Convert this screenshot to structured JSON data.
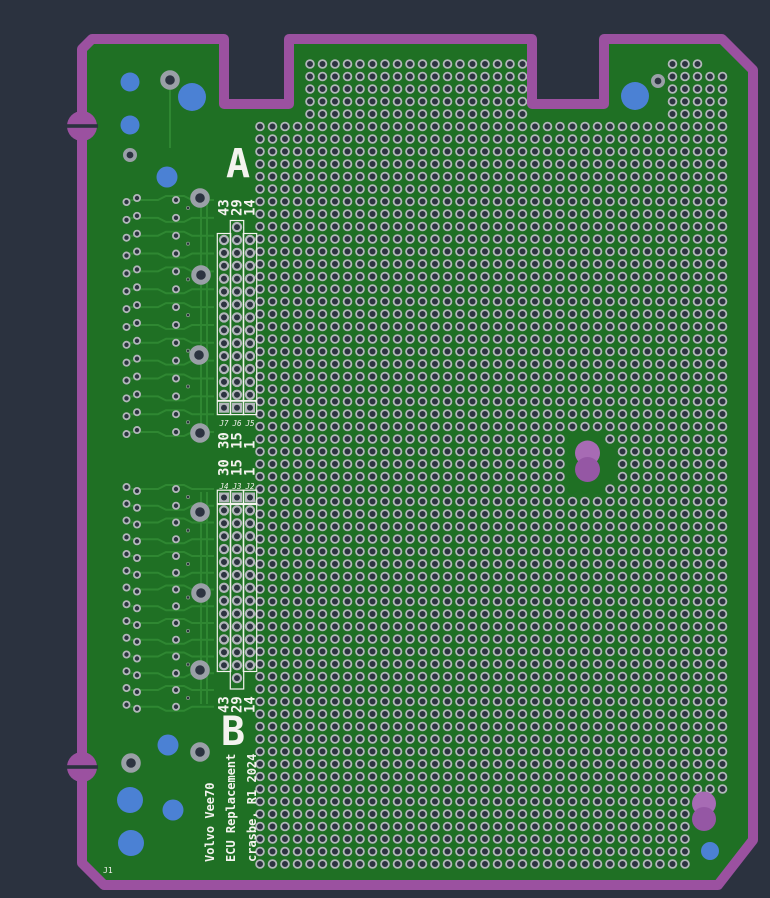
{
  "app": {
    "background": "#2b323f"
  },
  "labels": {
    "connector_a_letter": "A",
    "connector_b_letter": "B",
    "board_ref": "J1",
    "title_lines": [
      "Volvo Vee70",
      "ECU Replacement",
      "crasbe, R1 2024"
    ],
    "conn_a": {
      "top_numbers": [
        "43",
        "29",
        "14"
      ],
      "bottom_numbers": [
        "30",
        "15",
        "1"
      ],
      "refs": [
        "J7",
        "J6",
        "J5"
      ]
    },
    "conn_b": {
      "top_numbers": [
        "30",
        "15",
        "1"
      ],
      "bottom_numbers": [
        "43",
        "29",
        "14"
      ],
      "refs": [
        "J4",
        "J3",
        "J2"
      ]
    }
  },
  "colors": {
    "background": "#2b323f",
    "board_green": "#1f7024",
    "trace_green": "#2f8732",
    "edge_purple": "#9b51a0",
    "slot_purple": "#9557a4",
    "slot_purple_light": "#a76bb4",
    "pad_ring": "#b3b7bb",
    "pad_hole": "#2c3340",
    "via_ring": "#9aa0a7",
    "blue_hole": "#4b81d4",
    "silk_white": "#f4f3ef"
  },
  "perf_grid": {
    "pitch": 12.5,
    "pad_r": 3.9,
    "pad_ring_w": 1.8,
    "main": {
      "x0": 260,
      "y0": 126.5,
      "cols": 38,
      "rows": 60
    },
    "top_tab": {
      "x0": 310,
      "y0": 64,
      "cols": 18,
      "rows": 5
    },
    "top_right": {
      "x0": 672.5,
      "y0": 64,
      "cols": 5,
      "rows": 5
    },
    "void_ellipse": {
      "cx": 587.5,
      "cy": 463,
      "rx": 27,
      "ry": 33
    },
    "void_corner": {
      "x": 688,
      "y": 792
    }
  },
  "connectors": {
    "cols_x": [
      224,
      237,
      250
    ],
    "pitch": 12.9,
    "a": {
      "square_y": 407.7,
      "round_start": 240,
      "round_n": 13,
      "tall_col": 1,
      "tall_top": 227.1,
      "rect_top": 233.5,
      "rect_top_tall": 220.5,
      "rect_bottom": 400.5,
      "sq_box_top": 401.2,
      "refs_y": 424.5,
      "top_num_y": 216,
      "bot_num_y": 449
    },
    "b": {
      "square_y": 497.5,
      "round_start": 510.4,
      "round_n": 13,
      "tall_col": 1,
      "tall_bottom": 678.1,
      "rect_top": 504.5,
      "rect_bottom": 671.5,
      "rect_bottom_tall": 689,
      "sq_box_top": 490.2,
      "refs_y": 487.5,
      "top_num_y": 476,
      "bot_num_y": 713
    }
  },
  "left_circuit": {
    "upper": {
      "rows": 14,
      "y0": 200,
      "dy": 17.85,
      "pair_flip": 1
    },
    "lower": {
      "rows": 14,
      "y0": 489,
      "dy": 16.75,
      "pair_flip": -1
    },
    "pair_x": [
      126.5,
      137
    ],
    "single_x": 176,
    "dot_x": 188
  },
  "vias_big": [
    [
      170,
      80
    ],
    [
      200,
      198
    ],
    [
      201,
      275
    ],
    [
      199,
      355
    ],
    [
      200,
      433
    ],
    [
      200,
      512
    ],
    [
      201,
      593
    ],
    [
      200,
      670
    ],
    [
      200,
      752
    ],
    [
      131,
      763
    ]
  ],
  "vias_medium": [
    [
      130,
      155
    ],
    [
      658,
      81
    ]
  ],
  "blue_holes": [
    [
      130,
      82,
      9.5
    ],
    [
      192,
      97,
      14
    ],
    [
      130,
      125,
      9.5
    ],
    [
      167,
      177,
      10.5
    ],
    [
      635,
      96,
      14
    ],
    [
      168,
      745,
      10.5
    ],
    [
      130,
      800,
      13
    ],
    [
      173,
      810,
      10.5
    ],
    [
      131,
      843,
      13
    ],
    [
      710,
      851,
      9
    ]
  ],
  "slots": [
    {
      "cx": 587.5,
      "cy_top": 453,
      "cy_bot": 469.5,
      "r": 12.5
    },
    {
      "cx": 704,
      "cy_top": 803.5,
      "cy_bot": 819,
      "r": 12
    }
  ],
  "board_letter_a_pos": {
    "x": 238,
    "y": 177
  },
  "board_letter_b_pos": {
    "x": 233,
    "y": 745
  }
}
